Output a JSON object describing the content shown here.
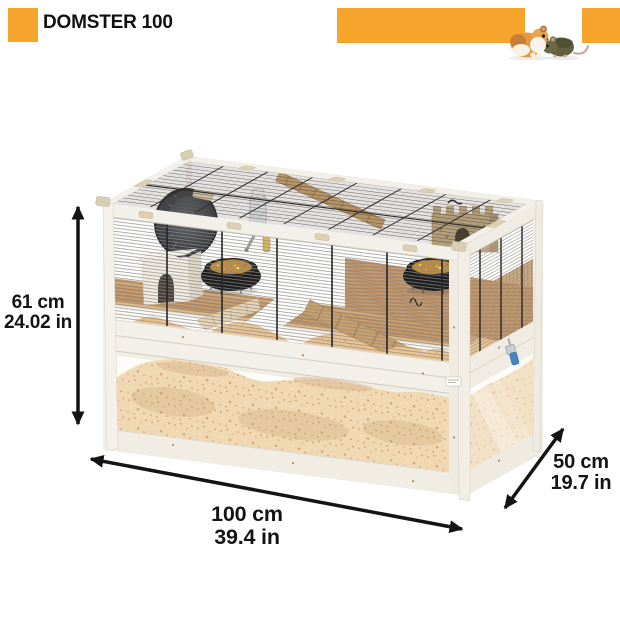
{
  "theme": {
    "accent_color": "#F5A42C",
    "arrow_color": "#141414",
    "background": "#FFFFFF",
    "frame_wood_white": "#F3F0E9",
    "platform_wood": "#C49768",
    "bedding_tan": "#EFD8B2",
    "mesh_wire_gray": "#8E8A83"
  },
  "header": {
    "title": "DOMSTER 100",
    "left_decor": "accent-square",
    "middle_decor": "accent-bar",
    "right_decor": "accent-square",
    "animals_image": "golden-hamster-and-brown-mouse-photo"
  },
  "product": {
    "illustration": "two-level wooden hamster cage: upper wire-mesh cage with accessories, lower deep bedding tray with clear panels",
    "visible_items": [
      "exercise-wheel",
      "nest-house",
      "food-bowl-left",
      "food-bowl-right",
      "castle-hide",
      "wooden-ramp",
      "water-bottle",
      "hanging-stick",
      "bedding",
      "blue-latch"
    ]
  },
  "dimensions": {
    "height": {
      "cm": "61 cm",
      "inches": "24.02 in"
    },
    "width": {
      "cm": "100 cm",
      "inches": "39.4 in"
    },
    "depth": {
      "cm": "50 cm",
      "inches": "19.7 in"
    }
  }
}
